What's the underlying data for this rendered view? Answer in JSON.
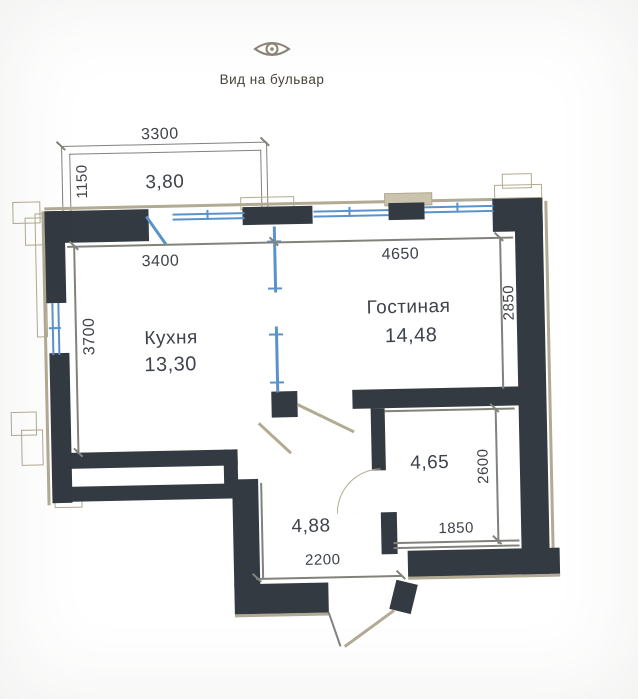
{
  "header": {
    "view_label": "Вид на бульвар"
  },
  "colors": {
    "background": "#e5e4e0",
    "wall": "#343a41",
    "window": "#5a93cc",
    "line": "#82827c",
    "decor": "#b2aa92",
    "text": "#3e434a",
    "icon": "#8d8573"
  },
  "rooms": {
    "balcony": {
      "area": "3,80",
      "width_mm": "3300",
      "depth_mm": "1150"
    },
    "kitchen": {
      "name": "Кухня",
      "area": "13,30",
      "width_mm": "3400",
      "depth_mm": "3700"
    },
    "living": {
      "name": "Гостиная",
      "area": "14,48",
      "width_mm": "4650",
      "depth_mm": "2850"
    },
    "bathroom": {
      "area": "4,65",
      "width_mm": "1850",
      "depth_mm": "2600"
    },
    "hallway": {
      "area": "4,88",
      "width_mm": "2200"
    }
  }
}
